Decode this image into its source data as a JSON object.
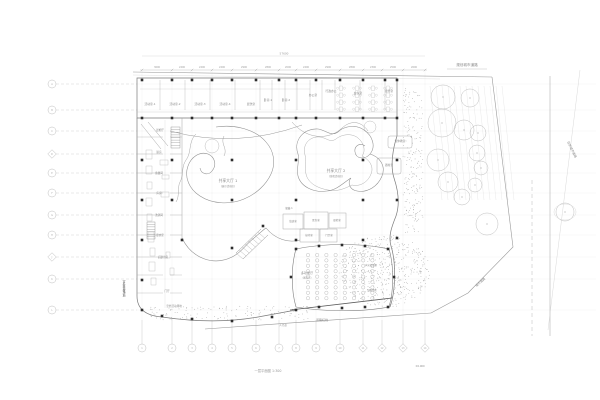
{
  "drawing": {
    "figure_title": "一层平面图 1:300",
    "type_note": "site-floor-plan"
  },
  "colors": {
    "background": "#ffffff",
    "line_faint": "#e0e0e0",
    "line_light": "#cccccc",
    "line_mid": "#9a9a9a",
    "line_dark": "#6e6e6e",
    "column": "#2d2d2d",
    "text": "#8a8a8a",
    "text_dark": "#4a4a4a",
    "stipple": "#9a9a9a"
  },
  "grid": {
    "left": {
      "x": 52,
      "y": [
        84,
        110,
        131,
        154,
        173,
        193,
        215,
        235,
        257,
        279,
        310
      ],
      "labels": [
        "A",
        "B",
        "C",
        "D",
        "E",
        "F",
        "G",
        "H",
        "J",
        "K",
        "L"
      ],
      "diamonds": [
        3,
        8
      ]
    },
    "bottom": {
      "y": 348,
      "x": [
        142,
        172,
        192,
        212,
        232,
        256,
        279,
        296,
        316,
        340,
        363,
        382,
        403,
        425
      ],
      "labels": [
        "1",
        "2",
        "3",
        "4",
        "5",
        "6",
        "7",
        "8",
        "9",
        "10",
        "11",
        "12",
        "13",
        "14"
      ],
      "diamonds": [
        10,
        11,
        12,
        13
      ]
    }
  },
  "dimensions": {
    "overall": {
      "text": "57600",
      "x": 284,
      "y": 54.5
    },
    "bays": [
      {
        "x": 157,
        "v": "3600"
      },
      {
        "x": 182,
        "v": "2400"
      },
      {
        "x": 202,
        "v": "2400"
      },
      {
        "x": 222,
        "v": "2400"
      },
      {
        "x": 244,
        "v": "2900"
      },
      {
        "x": 268,
        "v": "2800"
      },
      {
        "x": 288,
        "v": "2000"
      },
      {
        "x": 306,
        "v": "2400"
      },
      {
        "x": 328,
        "v": "2900"
      },
      {
        "x": 352,
        "v": "2800"
      },
      {
        "x": 373,
        "v": "2300"
      },
      {
        "x": 393,
        "v": "2500"
      },
      {
        "x": 414,
        "v": "2600"
      }
    ]
  },
  "halls": [
    {
      "x": 228,
      "y": 182,
      "t": "共享大厅 1",
      "sub": "(展示活动区)"
    },
    {
      "x": 336,
      "y": 172,
      "t": "共享大厅 2",
      "sub": "(游戏活动区)"
    }
  ],
  "rooms": {
    "top": [
      {
        "x": 150,
        "y": 105,
        "t": "活动室-1"
      },
      {
        "x": 175,
        "y": 105,
        "t": "活动室-2"
      },
      {
        "x": 200,
        "y": 105,
        "t": "活动室-3"
      },
      {
        "x": 225,
        "y": 105,
        "t": "活动室-4"
      },
      {
        "x": 251,
        "y": 105,
        "t": "盥洗室"
      },
      {
        "x": 268,
        "y": 101,
        "t": "卧室-1"
      },
      {
        "x": 286,
        "y": 101,
        "t": "卧室-2"
      },
      {
        "x": 313,
        "y": 96,
        "t": "办公室"
      },
      {
        "x": 331,
        "y": 92,
        "t": "行政办公"
      },
      {
        "x": 358,
        "y": 94,
        "t": "会议室"
      },
      {
        "x": 389,
        "y": 92,
        "t": "接待室"
      }
    ],
    "left_wing": [
      {
        "x": 160,
        "y": 131,
        "t": "晨检厅"
      },
      {
        "x": 159,
        "y": 153,
        "t": "厨房"
      },
      {
        "x": 159,
        "y": 174,
        "t": "备餐间"
      },
      {
        "x": 159,
        "y": 194,
        "t": "库房"
      },
      {
        "x": 159,
        "y": 216,
        "t": "洗消间"
      },
      {
        "x": 160,
        "y": 236,
        "t": "更衣室"
      },
      {
        "x": 163,
        "y": 258,
        "t": "后勤用房"
      },
      {
        "x": 167,
        "y": 292,
        "t": "门厅"
      }
    ],
    "center": [
      {
        "x": 289,
        "y": 209,
        "t": "储藏-1"
      },
      {
        "x": 293,
        "y": 222,
        "t": "值班室"
      },
      {
        "x": 316,
        "y": 221,
        "t": "医务室"
      },
      {
        "x": 337,
        "y": 221,
        "t": "晨检室"
      },
      {
        "x": 309,
        "y": 236,
        "t": "接待室"
      },
      {
        "x": 329,
        "y": 236,
        "t": "门卫室"
      }
    ],
    "right": [
      {
        "x": 400,
        "y": 142,
        "t": "音体教室"
      },
      {
        "x": 389,
        "y": 166,
        "t": "器材室"
      }
    ]
  },
  "auditorium": {
    "label": "多功能厅",
    "sub": "(报告厅)",
    "lx": 307,
    "ly": 274,
    "side_labels": [
      {
        "x": 371,
        "y": 266,
        "t": "声光控制室"
      },
      {
        "x": 372,
        "y": 291,
        "t": "设备用房"
      }
    ]
  },
  "roads": {
    "top": {
      "x": 467,
      "y": 66,
      "t": "规划城市道路"
    },
    "right": {
      "x": 571,
      "y": 150,
      "rot": 64,
      "t": "现状城市道路"
    },
    "corner": {
      "x": 481,
      "y": 283,
      "rot": -42,
      "t": "城市道路"
    },
    "redline": {
      "x": 322,
      "y": 321,
      "t": "道路红线"
    },
    "sidewalk": {
      "x": 283,
      "y": 326,
      "t": "人行道"
    },
    "level": {
      "x": 420,
      "y": 367,
      "t": "±0.000"
    }
  },
  "site": {
    "vlabel": {
      "x": 124,
      "y": 280,
      "t": "室外器械场地"
    },
    "glabel": {
      "x": 174,
      "y": 307,
      "t": "室外活动场地"
    }
  },
  "trees": [
    [
      443,
      97,
      12
    ],
    [
      470,
      98,
      9
    ],
    [
      442,
      123,
      14
    ],
    [
      464,
      130,
      10
    ],
    [
      478,
      133,
      8
    ],
    [
      438,
      160,
      11
    ],
    [
      477,
      153,
      8
    ],
    [
      481,
      168,
      7
    ],
    [
      448,
      182,
      10
    ],
    [
      475,
      185,
      7
    ],
    [
      462,
      197,
      8
    ],
    [
      487,
      224,
      11
    ],
    [
      565,
      212,
      9
    ]
  ],
  "hatch": {
    "x1": 430,
    "x2": 502,
    "step": 6,
    "ytop": 86,
    "ybot": 200,
    "slant": 12
  },
  "stipple_areas": [
    {
      "type": "rect",
      "x": 403,
      "y": 88,
      "w": 20,
      "h": 145,
      "n": 210
    },
    {
      "type": "ellipse",
      "cx": 384,
      "cy": 271,
      "rx": 46,
      "ry": 37,
      "n": 520
    },
    {
      "type": "rect",
      "x": 150,
      "y": 306,
      "w": 160,
      "h": 14,
      "n": 130
    }
  ],
  "seats": {
    "x0": 308,
    "cols": 8,
    "dx": 9.2,
    "y0": 255,
    "rows": 9,
    "dy": 5.4,
    "r": 1.7
  },
  "desks": {
    "xs": [
      341,
      357,
      373,
      388
    ],
    "y0": 86,
    "rows": 4,
    "dy": 7
  },
  "kitchen_rects": [
    [
      146,
      150,
      6,
      9
    ],
    [
      146,
      166,
      6,
      8
    ],
    [
      147,
      182,
      5,
      7
    ],
    [
      146,
      198,
      6,
      8
    ],
    [
      147,
      214,
      5,
      7
    ],
    [
      160,
      160,
      8,
      5
    ],
    [
      162,
      175,
      7,
      4
    ],
    [
      161,
      192,
      8,
      5
    ],
    [
      148,
      232,
      6,
      10
    ],
    [
      150,
      248,
      5,
      8
    ],
    [
      149,
      262,
      6,
      9
    ],
    [
      151,
      278,
      5,
      7
    ],
    [
      166,
      252,
      4,
      6
    ],
    [
      170,
      268,
      4,
      7
    ]
  ],
  "ladders": [
    {
      "x": 171,
      "y": 127,
      "w": 9,
      "h": 21,
      "n": 8
    },
    {
      "x": 147,
      "y": 222,
      "w": 8,
      "h": 17,
      "n": 7
    }
  ],
  "columns": {
    "wing_x": [
      142,
      172,
      192,
      212,
      232,
      256,
      279,
      296,
      316,
      340,
      363,
      385,
      397
    ],
    "wing_y": [
      80,
      118
    ],
    "interior": [
      [
        142,
        160
      ],
      [
        172,
        160
      ],
      [
        232,
        160
      ],
      [
        296,
        160
      ],
      [
        363,
        160
      ],
      [
        397,
        160
      ],
      [
        142,
        200
      ],
      [
        172,
        200
      ],
      [
        232,
        200
      ],
      [
        296,
        200
      ],
      [
        363,
        200
      ],
      [
        397,
        200
      ],
      [
        142,
        240
      ],
      [
        182,
        240
      ],
      [
        232,
        248
      ],
      [
        263,
        226
      ],
      [
        296,
        240
      ],
      [
        363,
        240
      ],
      [
        397,
        238
      ],
      [
        142,
        280
      ],
      [
        142,
        310
      ],
      [
        162,
        316
      ],
      [
        192,
        319
      ],
      [
        232,
        321
      ],
      [
        272,
        317
      ],
      [
        296,
        310
      ],
      [
        319,
        307
      ],
      [
        342,
        308
      ],
      [
        365,
        307
      ],
      [
        388,
        307
      ],
      [
        296,
        249
      ],
      [
        319,
        246
      ],
      [
        342,
        245
      ],
      [
        365,
        246
      ],
      [
        388,
        249
      ],
      [
        291,
        277
      ],
      [
        394,
        277
      ]
    ]
  },
  "top_wing_dividers": [
    160,
    185,
    210,
    235,
    260,
    272,
    285,
    297,
    310,
    322,
    335,
    360,
    385
  ],
  "left_wing_dividers": [
    137,
    154,
    173,
    193,
    215,
    235,
    257,
    275,
    293
  ]
}
